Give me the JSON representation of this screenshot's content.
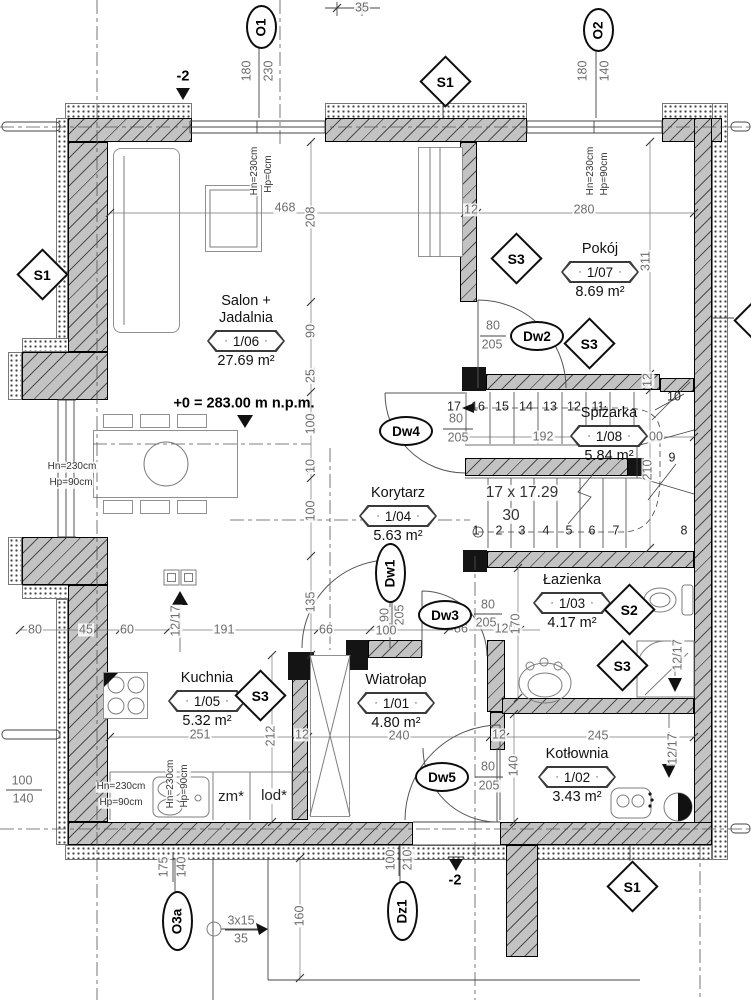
{
  "drawing": {
    "kind": "architectural floor plan, ground floor",
    "colors": {
      "wall_fill": "#c3c3c3",
      "line": "#444444",
      "dim_text": "#6e6e6e"
    }
  },
  "rooms": [
    {
      "id": "salon",
      "name_lines": [
        "Salon +",
        "Jadalnia"
      ],
      "number": "1/06",
      "area": "27.69 m²",
      "x": 246,
      "y": 293
    },
    {
      "id": "pokoj",
      "name_lines": [
        "Pokój"
      ],
      "number": "1/07",
      "area": "8.69 m²",
      "x": 600,
      "y": 241
    },
    {
      "id": "spizarka",
      "name_lines": [
        "Spiżarka"
      ],
      "number": "1/08",
      "area": "5.84 m²",
      "x": 609,
      "y": 405
    },
    {
      "id": "korytarz",
      "name_lines": [
        "Korytarz"
      ],
      "number": "1/04",
      "area": "5.63 m²",
      "x": 398,
      "y": 485
    },
    {
      "id": "lazienka",
      "name_lines": [
        "Łazienka"
      ],
      "number": "1/03",
      "area": "4.17 m²",
      "x": 572,
      "y": 572
    },
    {
      "id": "kuchnia",
      "name_lines": [
        "Kuchnia"
      ],
      "number": "1/05",
      "area": "5.32 m²",
      "x": 207,
      "y": 670
    },
    {
      "id": "wiatrolap",
      "name_lines": [
        "Wiatrołap"
      ],
      "number": "1/01",
      "area": "4.80 m²",
      "x": 396,
      "y": 672
    },
    {
      "id": "kotlownia",
      "name_lines": [
        "Kotłownia"
      ],
      "number": "1/02",
      "area": "3.43 m²",
      "x": 577,
      "y": 746
    }
  ],
  "section_markers": [
    {
      "label": "S1",
      "x": 40,
      "y": 272
    },
    {
      "label": "S1",
      "x": 443,
      "y": 79
    },
    {
      "label": "S1",
      "x": 630,
      "y": 884
    },
    {
      "label": "S3",
      "x": 514,
      "y": 256
    },
    {
      "label": "S3",
      "x": 587,
      "y": 341
    },
    {
      "label": "S3",
      "x": 258,
      "y": 693
    },
    {
      "label": "S3",
      "x": 620,
      "y": 663
    },
    {
      "label": "S2",
      "x": 627,
      "y": 607
    },
    {
      "label": "S3",
      "x": 757,
      "y": 318
    }
  ],
  "opening_markers": [
    {
      "label": "O1",
      "x": 259,
      "y": 25,
      "vertical": true
    },
    {
      "label": "O2",
      "x": 596,
      "y": 28,
      "vertical": true
    },
    {
      "label": "O3a",
      "x": 175,
      "y": 919,
      "vertical": true
    },
    {
      "label": "Dz1",
      "x": 400,
      "y": 909,
      "vertical": true
    },
    {
      "label": "Dw1",
      "x": 388,
      "y": 571,
      "vertical": true
    },
    {
      "label": "Dw2",
      "x": 535,
      "y": 334,
      "vertical": false
    },
    {
      "label": "Dw3",
      "x": 443,
      "y": 613,
      "vertical": false
    },
    {
      "label": "Dw4",
      "x": 404,
      "y": 429,
      "vertical": false
    },
    {
      "label": "Dw5",
      "x": 440,
      "y": 775,
      "vertical": false
    }
  ],
  "labels": [
    {
      "t": "35",
      "x": 362,
      "y": 8
    },
    {
      "t": "-2",
      "x": 183,
      "y": 77,
      "c": "lvl"
    },
    {
      "t": "180",
      "x": 247,
      "y": 71,
      "r": 1
    },
    {
      "t": "230",
      "x": 269,
      "y": 71,
      "r": 1
    },
    {
      "t": "180",
      "x": 583,
      "y": 71,
      "r": 1
    },
    {
      "t": "140",
      "x": 605,
      "y": 71,
      "r": 1
    },
    {
      "t": "Hn=230cm",
      "x": 255,
      "y": 171,
      "r": 1,
      "c": "sm"
    },
    {
      "t": "Hp=0cm",
      "x": 269,
      "y": 174,
      "r": 1,
      "c": "sm"
    },
    {
      "t": "Hn=230cm",
      "x": 591,
      "y": 171,
      "r": 1,
      "c": "sm"
    },
    {
      "t": "Hp=90cm",
      "x": 605,
      "y": 174,
      "r": 1,
      "c": "sm"
    },
    {
      "t": "468",
      "x": 285,
      "y": 208
    },
    {
      "t": "208",
      "x": 311,
      "y": 217,
      "r": 1
    },
    {
      "t": "12",
      "x": 471,
      "y": 210
    },
    {
      "t": "280",
      "x": 584,
      "y": 210
    },
    {
      "t": "311",
      "x": 646,
      "y": 261,
      "r": 1
    },
    {
      "t": "90",
      "x": 311,
      "y": 331,
      "r": 1
    },
    {
      "t": "25",
      "x": 311,
      "y": 376,
      "r": 1
    },
    {
      "t": "100",
      "x": 311,
      "y": 424,
      "r": 1
    },
    {
      "t": "10",
      "x": 311,
      "y": 466,
      "r": 1
    },
    {
      "t": "100",
      "x": 311,
      "y": 511,
      "r": 1
    },
    {
      "t": "135",
      "x": 311,
      "y": 602,
      "r": 1
    },
    {
      "t": "80",
      "x": 493,
      "y": 326
    },
    {
      "t": "205",
      "x": 492,
      "y": 345
    },
    {
      "t": "12",
      "x": 648,
      "y": 380,
      "r": 1
    },
    {
      "t": "10",
      "x": 674,
      "y": 397,
      "c": "st"
    },
    {
      "t": "9",
      "x": 672,
      "y": 458,
      "c": "st"
    },
    {
      "t": "8",
      "x": 684,
      "y": 531,
      "c": "st"
    },
    {
      "t": "80",
      "x": 456,
      "y": 419
    },
    {
      "t": "205",
      "x": 458,
      "y": 438
    },
    {
      "t": "192",
      "x": 543,
      "y": 437
    },
    {
      "t": "00",
      "x": 656,
      "y": 437
    },
    {
      "t": "210",
      "x": 648,
      "y": 470,
      "r": 1
    },
    {
      "t": "17 x 17.29",
      "x": 522,
      "y": 493,
      "c": "big"
    },
    {
      "t": "30",
      "x": 511,
      "y": 516,
      "c": "big"
    },
    {
      "t": "+0 = 283.00 m n.p.m.",
      "x": 244,
      "y": 404,
      "c": "lvl"
    },
    {
      "t": "90",
      "x": 385,
      "y": 615,
      "r": 1
    },
    {
      "t": "205",
      "x": 400,
      "y": 615,
      "r": 1
    },
    {
      "t": "100",
      "x": 386,
      "y": 631
    },
    {
      "t": "80",
      "x": 35,
      "y": 630
    },
    {
      "t": "45",
      "x": 86,
      "y": 630
    },
    {
      "t": "60",
      "x": 127,
      "y": 630
    },
    {
      "t": "12/17",
      "x": 176,
      "y": 621,
      "r": 1
    },
    {
      "t": "191",
      "x": 224,
      "y": 630
    },
    {
      "t": "66",
      "x": 326,
      "y": 630
    },
    {
      "t": "86",
      "x": 461,
      "y": 629
    },
    {
      "t": "120",
      "x": 505,
      "y": 629
    },
    {
      "t": "170",
      "x": 516,
      "y": 624,
      "r": 1
    },
    {
      "t": "80",
      "x": 488,
      "y": 605
    },
    {
      "t": "205",
      "x": 486,
      "y": 623
    },
    {
      "t": "Hn=230cm",
      "x": 72,
      "y": 467,
      "c": "sm"
    },
    {
      "t": "Hp=90cm",
      "x": 71,
      "y": 483,
      "c": "sm"
    },
    {
      "t": "Hn=230cm",
      "x": 121,
      "y": 787,
      "c": "sm"
    },
    {
      "t": "Hp=90cm",
      "x": 121,
      "y": 803,
      "c": "sm"
    },
    {
      "t": "Hn=230cm",
      "x": 171,
      "y": 784,
      "r": 1,
      "c": "sm"
    },
    {
      "t": "Hp=90cm",
      "x": 185,
      "y": 786,
      "r": 1,
      "c": "sm"
    },
    {
      "t": "zm*",
      "x": 231,
      "y": 797,
      "c": "fix"
    },
    {
      "t": "lod*",
      "x": 274,
      "y": 796,
      "c": "fix"
    },
    {
      "t": "251",
      "x": 200,
      "y": 735
    },
    {
      "t": "212",
      "x": 271,
      "y": 736,
      "r": 1
    },
    {
      "t": "12",
      "x": 302,
      "y": 735
    },
    {
      "t": "240",
      "x": 399,
      "y": 736
    },
    {
      "t": "12",
      "x": 499,
      "y": 735
    },
    {
      "t": "245",
      "x": 598,
      "y": 736
    },
    {
      "t": "140",
      "x": 514,
      "y": 766,
      "r": 1
    },
    {
      "t": "80",
      "x": 488,
      "y": 767
    },
    {
      "t": "205",
      "x": 489,
      "y": 786
    },
    {
      "t": "12/17",
      "x": 678,
      "y": 655,
      "r": 1
    },
    {
      "t": "12/17",
      "x": 673,
      "y": 749,
      "r": 1
    },
    {
      "t": "100",
      "x": 22,
      "y": 781
    },
    {
      "t": "140",
      "x": 23,
      "y": 799
    },
    {
      "t": "175",
      "x": 164,
      "y": 867,
      "r": 1
    },
    {
      "t": "140",
      "x": 182,
      "y": 867,
      "r": 1
    },
    {
      "t": "100",
      "x": 391,
      "y": 860,
      "r": 1
    },
    {
      "t": "210",
      "x": 408,
      "y": 860,
      "r": 1
    },
    {
      "t": "-2",
      "x": 455,
      "y": 881,
      "c": "lvl"
    },
    {
      "t": "3x15",
      "x": 241,
      "y": 921
    },
    {
      "t": "35",
      "x": 241,
      "y": 939
    },
    {
      "t": "160",
      "x": 300,
      "y": 916,
      "r": 1
    },
    {
      "t": "17",
      "x": 454,
      "y": 407,
      "c": "st"
    },
    {
      "t": "16",
      "x": 478,
      "y": 407,
      "c": "st"
    },
    {
      "t": "15",
      "x": 502,
      "y": 407,
      "c": "st"
    },
    {
      "t": "14",
      "x": 526,
      "y": 407,
      "c": "st"
    },
    {
      "t": "13",
      "x": 550,
      "y": 407,
      "c": "st"
    },
    {
      "t": "12",
      "x": 574,
      "y": 407,
      "c": "st"
    },
    {
      "t": "11",
      "x": 598,
      "y": 407,
      "c": "st"
    },
    {
      "t": "1",
      "x": 476,
      "y": 531,
      "c": "st"
    },
    {
      "t": "2",
      "x": 499,
      "y": 531,
      "c": "st"
    },
    {
      "t": "3",
      "x": 522,
      "y": 531,
      "c": "st"
    },
    {
      "t": "4",
      "x": 546,
      "y": 531,
      "c": "st"
    },
    {
      "t": "5",
      "x": 569,
      "y": 531,
      "c": "st"
    },
    {
      "t": "6",
      "x": 592,
      "y": 531,
      "c": "st"
    },
    {
      "t": "7",
      "x": 616,
      "y": 531,
      "c": "st"
    }
  ]
}
